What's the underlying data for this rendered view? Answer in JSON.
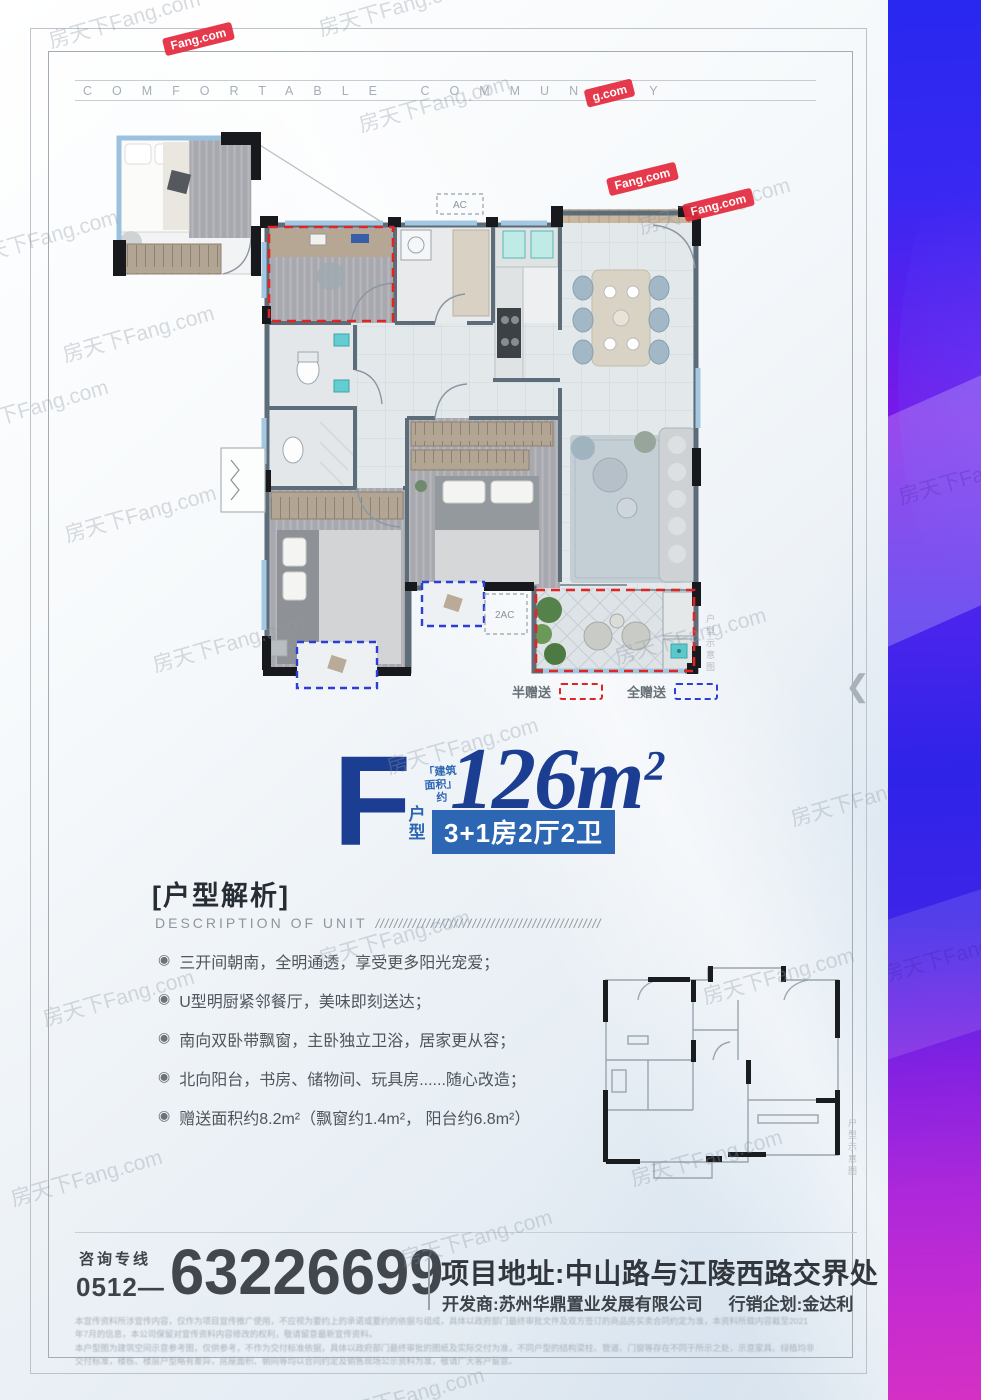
{
  "banner": {
    "text": "COMFORTABLE COMMUNITY"
  },
  "watermark": {
    "text": "房天下Fang.com",
    "chip": "Fang.com",
    "chip_short": "g.com"
  },
  "plan": {
    "ac_label_top": "AC",
    "ac_label": "2AC",
    "legend": {
      "half": "半赠送",
      "full": "全赠送"
    },
    "side_note": "户型示意图"
  },
  "mini_plan": {
    "side_note": "户型示意图"
  },
  "unit": {
    "letter": "F",
    "area_note_1": "「建筑",
    "area_note_2": "面积」",
    "area_note_3": "约",
    "area_value": "126m",
    "area_sup": "2",
    "type_label_1": "户",
    "type_label_2": "型",
    "spec": "3+1房2厅2卫"
  },
  "description": {
    "title": "[户型解析]",
    "subtitle": "DESCRIPTION OF UNIT",
    "slashes": "/////////////////////////////////////////////////",
    "bullet_icon": "◉",
    "bullets": [
      "三开间朝南，全明通透，享受更多阳光宠爱；",
      "U型明厨紧邻餐厅，美味即刻送达；",
      "南向双卧带飘窗，主卧独立卫浴，居家更从容；",
      "北向阳台，书房、储物间、玩具房......随心改造；",
      "赠送面积约8.2m²（飘窗约1.4m²， 阳台约6.8m²）"
    ]
  },
  "contact": {
    "hotline_label": "咨询专线",
    "area_code": "0512—",
    "phone": "63226699",
    "address": "项目地址:中山路与江陵西路交界处",
    "developer": "开发商:苏州华鼎置业发展有限公司",
    "marketing": "行销企划:金达利"
  },
  "disclaimer": {
    "line1": "本宣传资料所涉宣传内容，仅作为项目宣传推广使用，不应视为要约上的承诺或要约的依据与组成，具体以政府部门最终审批文件及双方签订的商品房买卖合同约定为准，本资料所载内容截至2021",
    "line2": "年7月的信息，本公司保留对宣传资料内容修改的权利，敬请留意最新宣传资料。",
    "line3": "本户型图为建筑空间示意参考图，仅供参考，不作为交付标准依据，具体以政府部门最终审批的图纸及实际交付为准，不同户型的结构梁柱、管道、门窗等存在不同于所示之处，示意家具、绿植均非",
    "line4": "交付标准，楼栋、楼层户型略有差异，房屋面积、朝向等均以合同约定及销售现场公示资料为准，敬请广大客户留意。"
  }
}
